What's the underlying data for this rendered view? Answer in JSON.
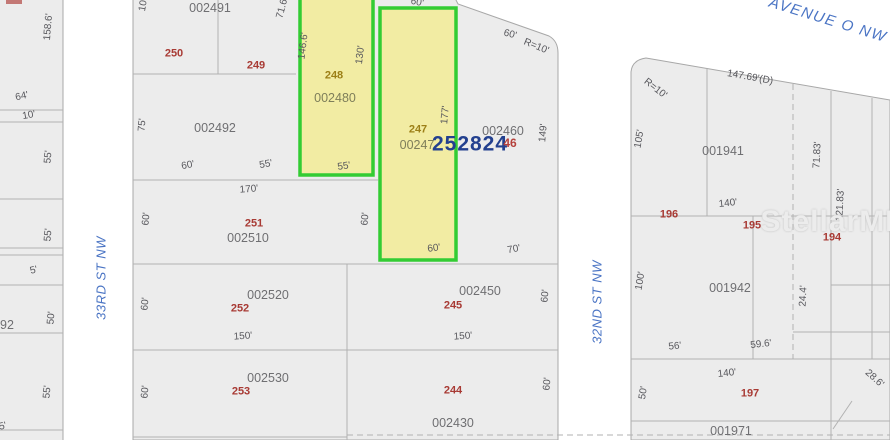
{
  "streets": {
    "avenue_o": "AVENUE O NW",
    "st_33rd": "33RD ST NW",
    "st_32nd": "32ND ST NW"
  },
  "watermark": "StellarMLS",
  "highlight": {
    "lot_248": "248",
    "apn_248": "002480",
    "lot_247": "247",
    "apn_247": "00247",
    "overlay_id": "252824",
    "overlay_46": "46",
    "dims": {
      "d146_6": "146.6'",
      "d130": "130'",
      "d55": "55'",
      "d60_top": "60'",
      "d177": "177'",
      "d60_bottom": "60'"
    }
  },
  "parcels": {
    "p002491": "002491",
    "p002492": "002492",
    "p002510": "002510",
    "p002520": "002520",
    "p002530": "002530",
    "p002450": "002450",
    "p002430": "002430",
    "p002460": "002460",
    "p001941": "001941",
    "p001942": "001942",
    "p001971": "001971",
    "p_partial": "92"
  },
  "lots": {
    "l250": "250",
    "l249": "249",
    "l251": "251",
    "l252": "252",
    "l253": "253",
    "l245": "245",
    "l244": "244",
    "l196": "196",
    "l195": "195",
    "l194": "194",
    "l197": "197"
  },
  "dims": {
    "d_158_6": "158.6'",
    "d_64": "64'",
    "d_10": "10'",
    "d_55_a": "55'",
    "d_55_b": "55'",
    "d_5_a": "5'",
    "d_50": "50'",
    "d_55_c": "55'",
    "d_5_b": "5'",
    "d_10_top": "10'",
    "d_71_6": "71.6'",
    "d_75": "75'",
    "d_60_a": "60'",
    "d_55_d": "55'",
    "d_170": "170'",
    "d_60_b": "60'",
    "d_60_c": "60'",
    "d_60_d": "60'",
    "d_150_a": "150'",
    "d_60_e": "60'",
    "d_70": "70'",
    "d_60_f": "60'",
    "d_150_b": "150'",
    "d_60_g": "60'",
    "d_60_ave": "60'",
    "d_r10_a": "R=10'",
    "d_149": "149'",
    "d_147_69": "147.69'(D)",
    "d_r10_b": "R=10'",
    "d_105": "105'",
    "d_71_83": "71.83'",
    "d_140_a": "140'",
    "d_121_83": "121.83'",
    "d_100": "100'",
    "d_24_4": "24.4'",
    "d_56": "56'",
    "d_59_6": "59.6'",
    "d_140_b": "140'",
    "d_50_b": "50'",
    "d_28_6": "28.6'"
  },
  "colors": {
    "highlight_fill": "#f2eca3",
    "highlight_border": "#33cc33",
    "parcel_fill": "#ececec",
    "parcel_border": "#a8a8a8",
    "lot_red": "#a83a34",
    "lot_olive": "#9c7f17",
    "street_blue": "#4a74c4",
    "overlay_navy": "#23408f"
  }
}
